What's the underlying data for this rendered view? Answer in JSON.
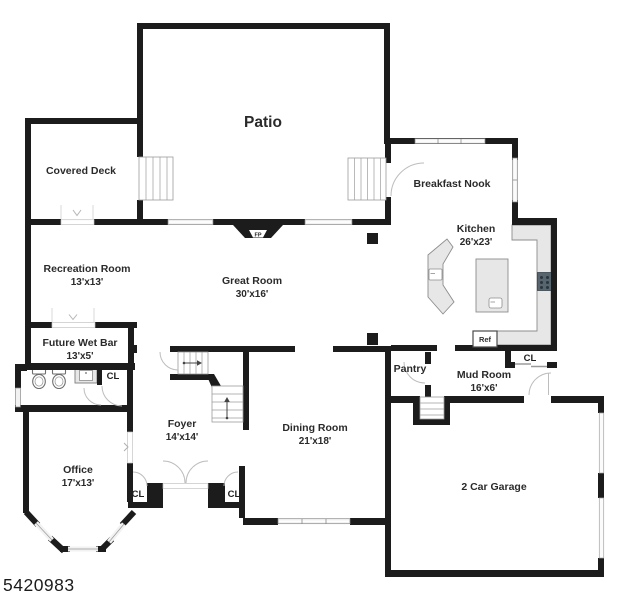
{
  "floor_plan": {
    "listing_id": "5420983",
    "rooms": {
      "patio": {
        "name": "Patio"
      },
      "covered_deck": {
        "name": "Covered Deck"
      },
      "breakfast_nook": {
        "name": "Breakfast Nook"
      },
      "kitchen": {
        "name": "Kitchen",
        "dims": "26'x23'"
      },
      "recreation_room": {
        "name": "Recreation Room",
        "dims": "13'x13'"
      },
      "great_room": {
        "name": "Great Room",
        "dims": "30'x16'"
      },
      "future_wet_bar": {
        "name": "Future Wet Bar",
        "dims": "13'x5'"
      },
      "foyer": {
        "name": "Foyer",
        "dims": "14'x14'"
      },
      "dining_room": {
        "name": "Dining Room",
        "dims": "21'x18'"
      },
      "office": {
        "name": "Office",
        "dims": "17'x13'"
      },
      "pantry": {
        "name": "Pantry"
      },
      "mud_room": {
        "name": "Mud Room",
        "dims": "16'x6'"
      },
      "garage": {
        "name": "2 Car Garage"
      }
    },
    "labels": {
      "closet": "CL",
      "refrigerator": "Ref",
      "fireplace": "FP"
    },
    "palette": {
      "wall": "#1c1c1c",
      "window": "#f2f2f2",
      "counter": "#e7e7e7",
      "stove": "#56656f",
      "text": "#2a2a2a",
      "background": "#ffffff"
    }
  }
}
